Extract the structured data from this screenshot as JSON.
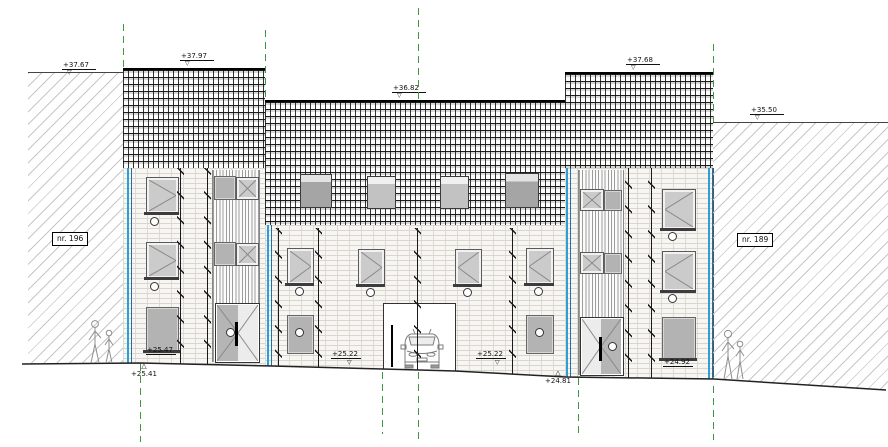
{
  "drawing": {
    "type": "architectural street elevation",
    "house_numbers": {
      "left": "nr. 196",
      "right": "nr. 189"
    },
    "levels": {
      "left_neighbor_roof": "+37.67",
      "left_building_roof": "+37.97",
      "center_roof": "+36.82",
      "right_building_roof": "+37.68",
      "right_neighbor_roof": "+35.50"
    },
    "ground_levels": {
      "left_floor": "+25.47",
      "left_ground": "+25.41",
      "center_left": "+25.22",
      "center_right": "+25.22",
      "right_ground": "+24.81",
      "right_floor": "+24.92"
    },
    "glyphs": {
      "level_marker": "▽",
      "datum_marker": "△"
    },
    "colors": {
      "party_wall_blue": "#2e9fd4",
      "grid_green": "#3d9940",
      "line": "#1a1a1a",
      "brick_joint": "#d9d6d0",
      "neighbor_hatch": "#c7c7c7"
    }
  }
}
